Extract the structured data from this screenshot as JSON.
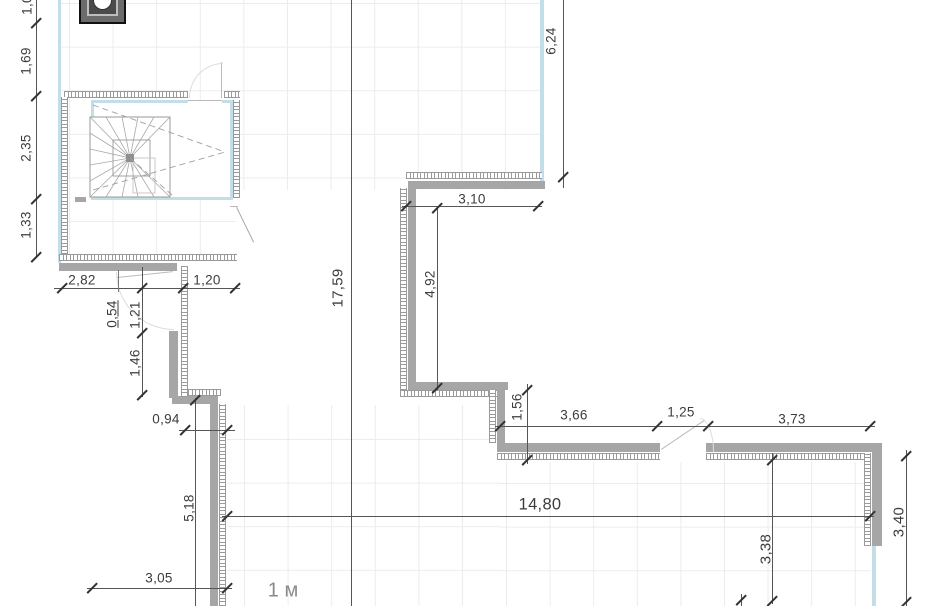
{
  "scale_label": "1 м",
  "dims": {
    "left_chain": [
      "1,0",
      "1,69",
      "2,35",
      "1,33"
    ],
    "upper_left_width": "2,82",
    "upper_left_offset": "1,20",
    "niche_a": "0,54",
    "niche_b": "1,21",
    "niche_c": "1,46",
    "step_offset": "0,94",
    "left_run": "5,18",
    "bottom_left_width": "3,05",
    "overall_height": "17,59",
    "top_width": "3,10",
    "mid_height": "4,92",
    "right_top_height": "6,24",
    "notch_height": "1,56",
    "bottom_run": [
      "3,66",
      "1,25",
      "3,73"
    ],
    "overall_width": "14,80",
    "lower_right_height": "3,38",
    "right_edge_height": "3,40"
  },
  "colors": {
    "wall": "#a6a6a6",
    "insulation": "#999999",
    "finish_blue": "#c3dde9",
    "dimension": "#3c3c3c",
    "grid": "#ececec"
  }
}
